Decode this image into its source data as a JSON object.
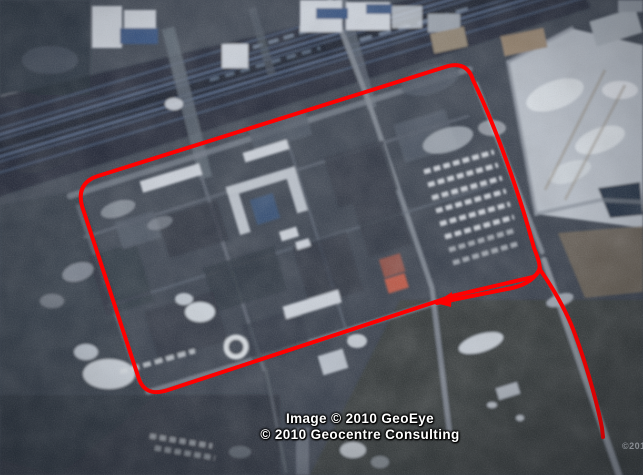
{
  "map": {
    "view": "satellite",
    "attribution": {
      "line1": "Image © 2010 GeoEye",
      "line2": "© 2010 Geocentre Consulting"
    },
    "corner_watermark": "©2010",
    "route_color": "#ff0000",
    "route": {
      "loop_d": "M438,301 L168,390 Q144,398 138,376 L82,206 Q76,183 98,176 L445,67 Q467,60 473,80 C495,125 520,195 534,248 C539,261 544,271 533,277 L452,296 Q444,299 438,301 Z",
      "inner_line_d": "M437,303 L512,288 Q534,283 540,268",
      "exit_line_d": "M541,271 C550,284 561,301 571,324 C582,351 596,397 602,428 L603,437",
      "arrow_points": "435,303 452,292 451,307"
    }
  }
}
